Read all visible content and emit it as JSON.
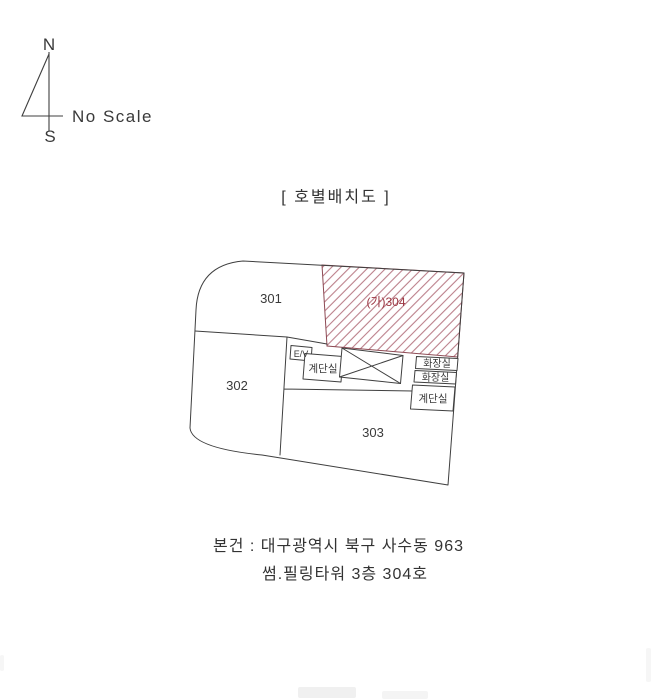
{
  "compass": {
    "north_label": "N",
    "south_label": "S",
    "scale_note": "No Scale"
  },
  "title": "[ 호별배치도 ]",
  "plan": {
    "units": [
      {
        "id": "301",
        "label": "301"
      },
      {
        "id": "302",
        "label": "302"
      },
      {
        "id": "303",
        "label": "303"
      },
      {
        "id": "304",
        "label": "(가)304",
        "highlighted": true
      }
    ],
    "rooms": {
      "elevator": "E/V",
      "stair_left": "계단실",
      "toilet_upper": "화장실",
      "toilet_lower": "화장실",
      "stair_right": "계단실"
    },
    "colors": {
      "line": "#3f3f3f",
      "text": "#3a3a3a",
      "hatch_line": "#bb7f8a",
      "hatch_border": "#8d4a54",
      "subject_text": "#9c3642"
    }
  },
  "footer": {
    "line1": "본건 : 대구광역시 북구 사수동 963",
    "line2": "썸.필링타워 3층 304호"
  }
}
